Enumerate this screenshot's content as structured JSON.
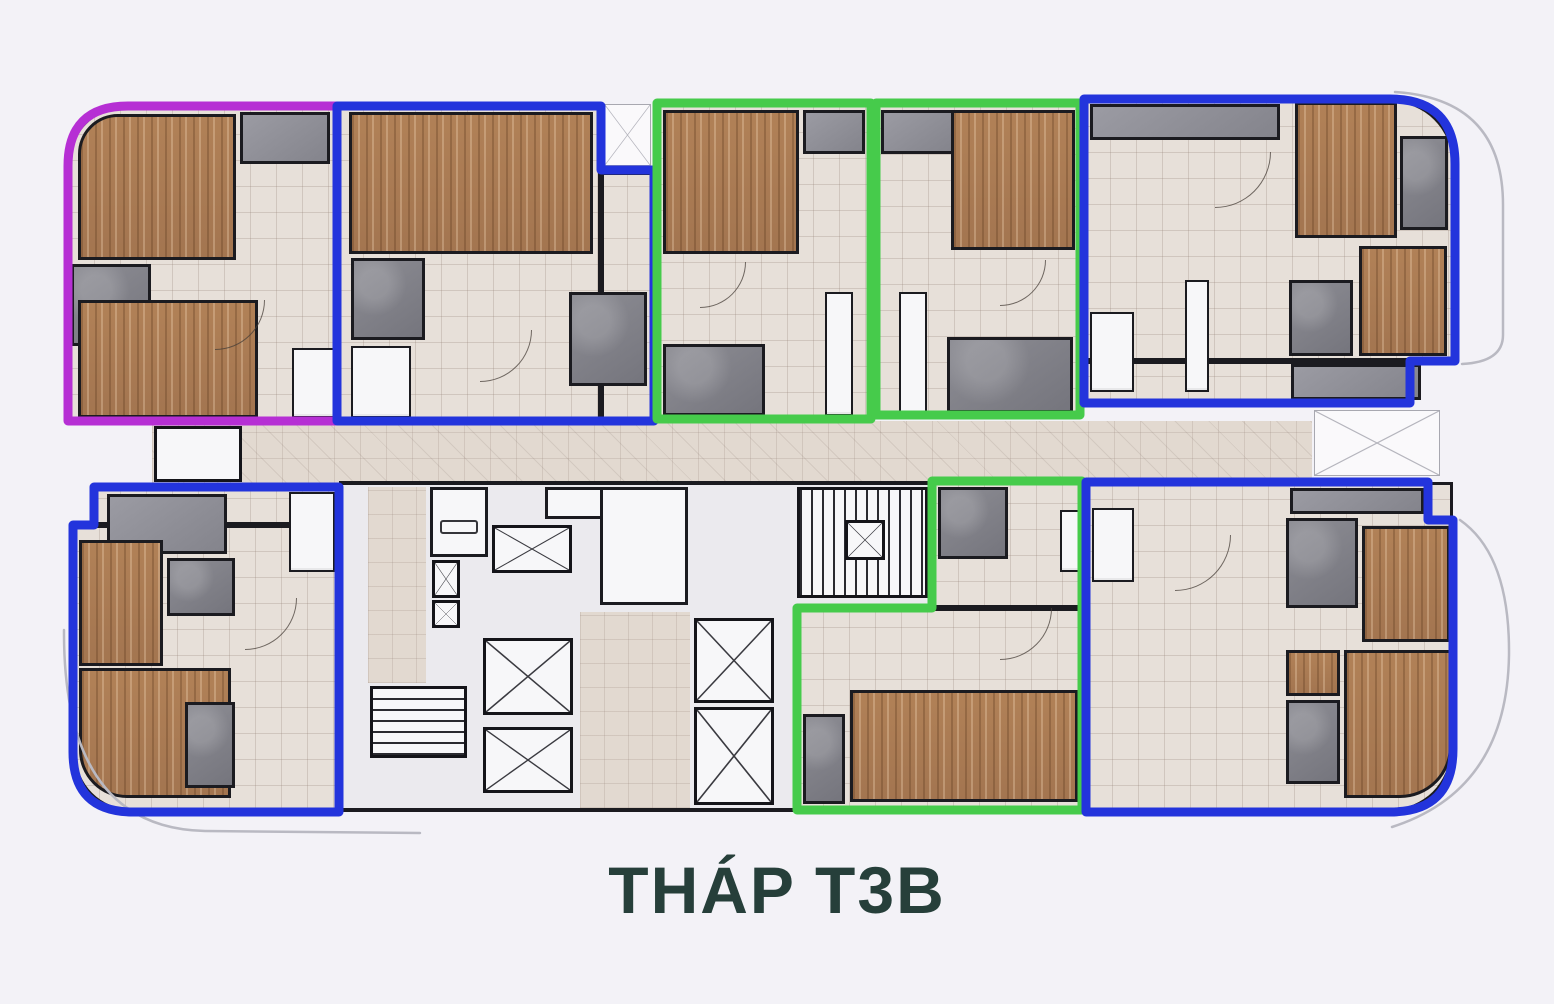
{
  "title": "THÁP T3B",
  "colors": {
    "bg": "#f3f2f7",
    "magenta": "#b62fd4",
    "blue": "#2334dc",
    "green": "#46cb4b",
    "wall": "#1b1b20",
    "wood": "#b18157",
    "floor": "#e7e0d9",
    "corridor": "#e2d9d0",
    "bath": "#8d8d94",
    "closet": "#9b9ba3",
    "core": "#ebeaee",
    "fixture": "#f7f7f9",
    "facade": "#b9b9c2",
    "title": "#263f3a"
  },
  "tower": {
    "name": "THÁP T3B",
    "unit_count": 8
  },
  "units": [
    {
      "position": "top-left",
      "outline_color": "magenta",
      "rounded_corner": "top-left"
    },
    {
      "position": "top-left-center",
      "outline_color": "blue",
      "rounded_corner": "none"
    },
    {
      "position": "top-center-left",
      "outline_color": "green",
      "rounded_corner": "none"
    },
    {
      "position": "top-center-right",
      "outline_color": "green",
      "rounded_corner": "none"
    },
    {
      "position": "top-right",
      "outline_color": "blue",
      "rounded_corner": "top-right"
    },
    {
      "position": "bottom-left",
      "outline_color": "blue",
      "rounded_corner": "bottom-left"
    },
    {
      "position": "bottom-center",
      "outline_color": "green",
      "rounded_corner": "none",
      "shape": "L"
    },
    {
      "position": "bottom-right",
      "outline_color": "blue",
      "rounded_corner": "bottom-right"
    }
  ],
  "core_features": [
    "corridor",
    "elevator-shafts",
    "stairwells",
    "lobby"
  ]
}
